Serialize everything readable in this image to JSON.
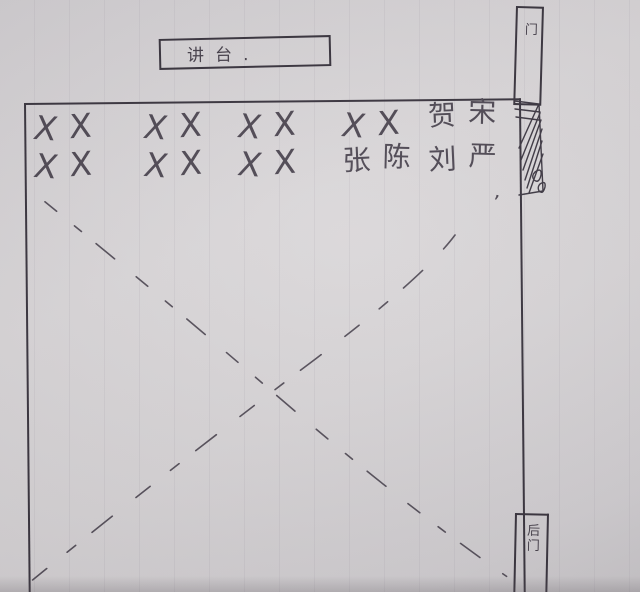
{
  "podium": {
    "label": "讲台."
  },
  "doors": {
    "front": {
      "label": "门"
    },
    "back": {
      "label": "后门"
    }
  },
  "seating": {
    "rows": [
      {
        "groups": [
          [
            "X",
            "X"
          ],
          [
            "X",
            "X"
          ],
          [
            "X",
            "X"
          ],
          [
            "X",
            "X"
          ],
          [
            "贺",
            "宋"
          ]
        ]
      },
      {
        "groups": [
          [
            "X",
            "X"
          ],
          [
            "X",
            "X"
          ],
          [
            "X",
            "X"
          ],
          [
            "张",
            "陈"
          ],
          [
            "刘",
            "严"
          ]
        ]
      }
    ],
    "student_names": [
      "贺",
      "宋",
      "张",
      "陈",
      "刘",
      "严"
    ]
  },
  "annotations": {
    "stray_comma": ",",
    "cross_mark": "dashed X across empty floor area"
  },
  "colors": {
    "paper": "#d7d4d6",
    "ink": "#36313b",
    "pencil": "#4c4651"
  }
}
